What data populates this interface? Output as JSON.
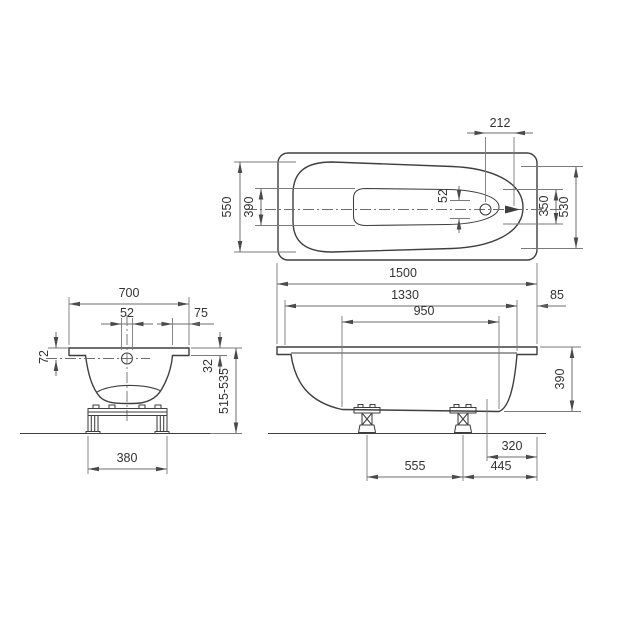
{
  "drawing": {
    "top_view": {
      "drain_offset": "212",
      "inner_width_foot_end": "550",
      "floor_width_foot_end": "390",
      "drain_hole": "52",
      "floor_width_head_end": "350",
      "inner_width_head_end": "530"
    },
    "side_view": {
      "overall_length": "1500",
      "inner_length": "1330",
      "rim_overhang": "85",
      "floor_length": "950",
      "depth": "390",
      "drain_to_end": "320",
      "feet_spacing": "555",
      "foot_to_end": "445"
    },
    "front_view": {
      "overall_width": "700",
      "drain_hole": "52",
      "rim_lip": "75",
      "drain_depth": "72",
      "rim_height": "32",
      "install_height": "515-535",
      "support_width": "380"
    }
  }
}
